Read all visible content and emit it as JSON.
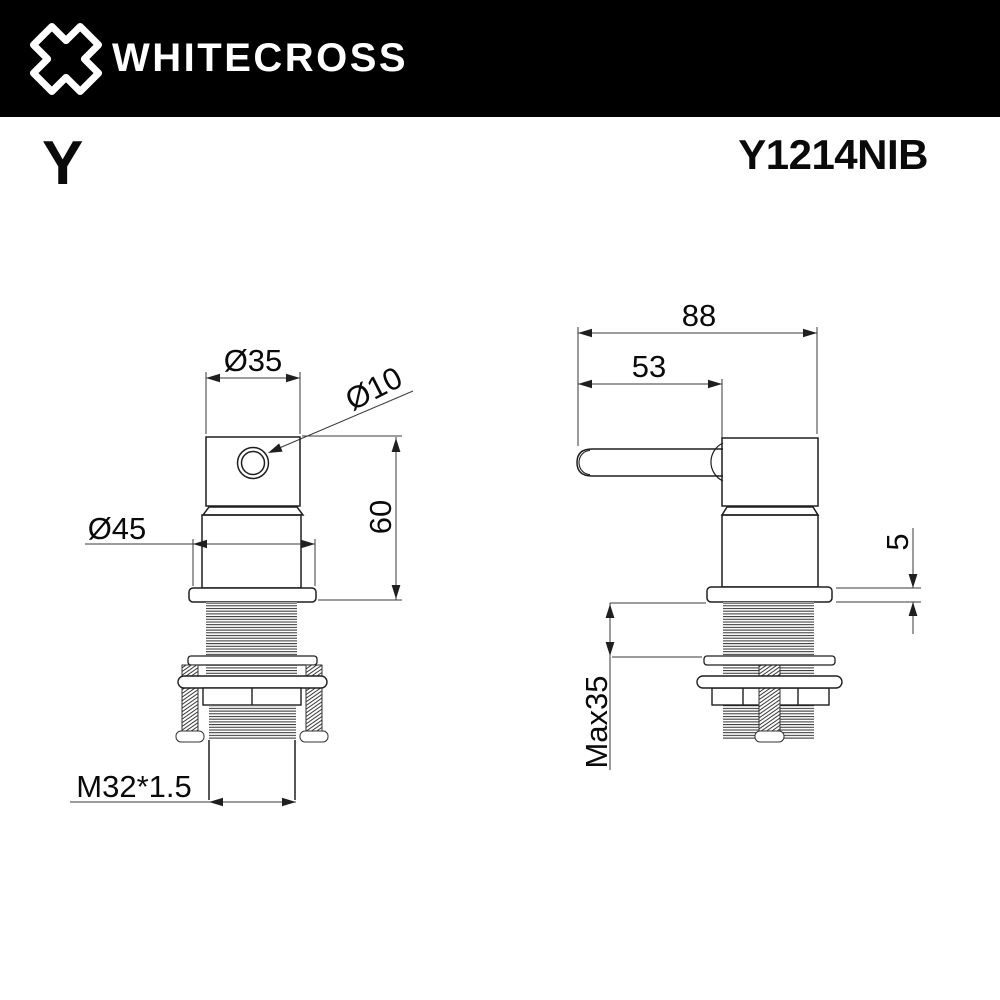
{
  "header": {
    "brand": "WHITECROSS"
  },
  "product": {
    "series": "Y",
    "model": "Y1214NIB"
  },
  "views": {
    "front": {
      "dims": {
        "top_diameter": "Ø35",
        "hole_diameter": "Ø10",
        "body_diameter": "Ø45",
        "height": "60",
        "thread": "M32*1.5"
      }
    },
    "side": {
      "dims": {
        "depth": "88",
        "handle_length": "53",
        "flange_thickness": "5",
        "max_mounting_depth": "Max35"
      }
    }
  },
  "colors": {
    "header_bg": "#000000",
    "logo": "#ffffff",
    "outline": "#1f1f1f",
    "dimension_lines": "#3a3a3a",
    "text": "#0a0a0a",
    "background": "#ffffff"
  }
}
